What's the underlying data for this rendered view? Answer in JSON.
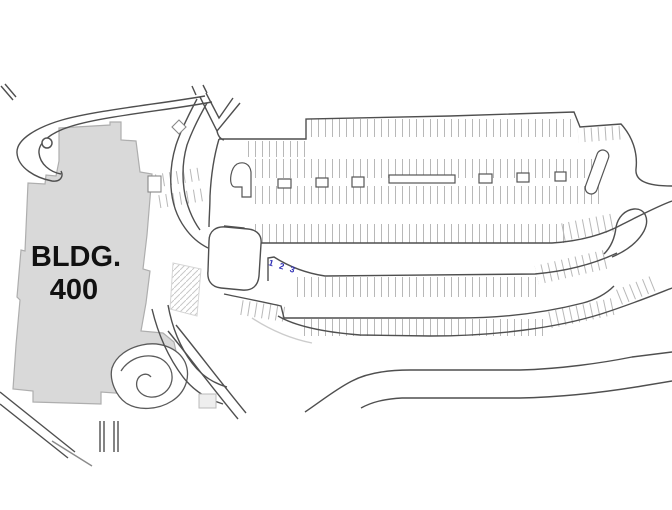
{
  "building": {
    "name": "BLDG. 400",
    "label_line1": "BLDG.",
    "label_line2": "400",
    "fill_color": "#d9d9d9"
  },
  "parking_lot": {
    "stall_numbers_label": "1 2 3",
    "stall_numbers_color": "#2b2bb4"
  },
  "colors": {
    "background": "#ffffff",
    "road_line": "#4f4f4f",
    "stall_tick": "#b8b8b8",
    "building_fill": "#d9d9d9",
    "building_stroke": "#aeaeae",
    "hatch": "#c9c9c9"
  }
}
